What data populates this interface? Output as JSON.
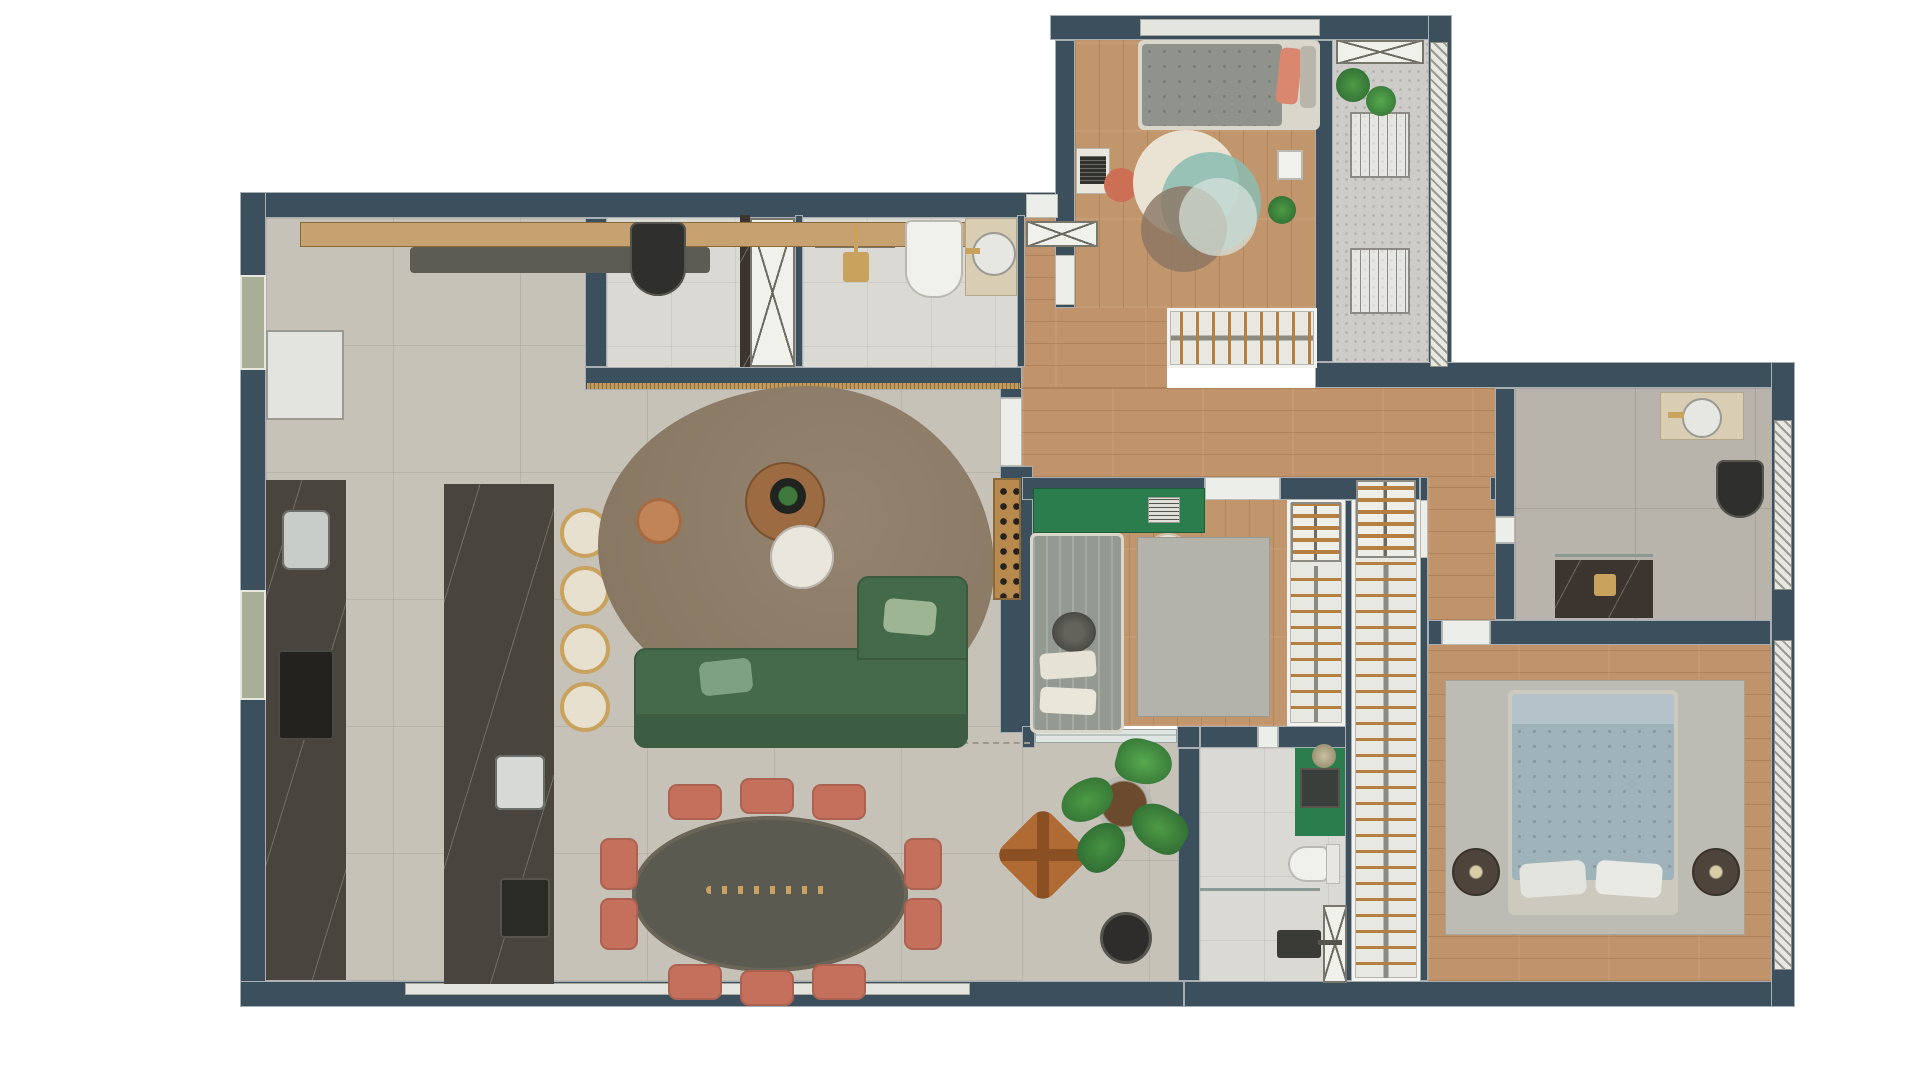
{
  "plan_title": "apartment-floor-plan",
  "unit": "m",
  "colors": {
    "wall": "#3c4f5c",
    "wood_floor": "#c2966c",
    "living_tile": "#c6c2b8",
    "bath_tile": "#dad9d3",
    "green_accent": "#2c7d4e",
    "coral_accent": "#c4705c",
    "sofa_green": "#456a4b",
    "gold_fixture": "#c9a25e",
    "master_blue": "#9fb3ba",
    "label_text": "#53626b"
  },
  "rooms": {
    "living_kitchen": {
      "labels": {
        "top_width": "3.43",
        "length": "6.12",
        "bottom_width": "7.10",
        "island_length": "7.85",
        "kitchen_width": "2.08",
        "opening": "0.91"
      }
    },
    "entry_hall": {
      "labels": {
        "length": "3.37"
      }
    },
    "lavabo": {
      "labels": {
        "width": "1.24",
        "depth": "1.53"
      }
    },
    "social_bathroom": {
      "labels": {
        "width": "2.35",
        "depth": "1.53"
      }
    },
    "bedroom_1": {
      "labels": {
        "width": "2.51"
      }
    },
    "technical_area": {
      "labels": {
        "depth": "3.04",
        "width": "0.90"
      }
    },
    "corridor": {
      "labels": {
        "segment_a": "2.90",
        "segment_b": "1.75",
        "width": "2.56"
      }
    },
    "bedroom_2": {
      "labels": {
        "width": "3.20",
        "closet_depth": "2.50"
      }
    },
    "suite_bathroom": {
      "labels": {
        "width": "1.38",
        "depth": "2.41"
      }
    },
    "walk_in_closet": {
      "labels": {
        "length": "5.16"
      }
    },
    "master_bathroom": {
      "labels": {
        "depth": "2.41",
        "width": "1.58"
      }
    }
  }
}
